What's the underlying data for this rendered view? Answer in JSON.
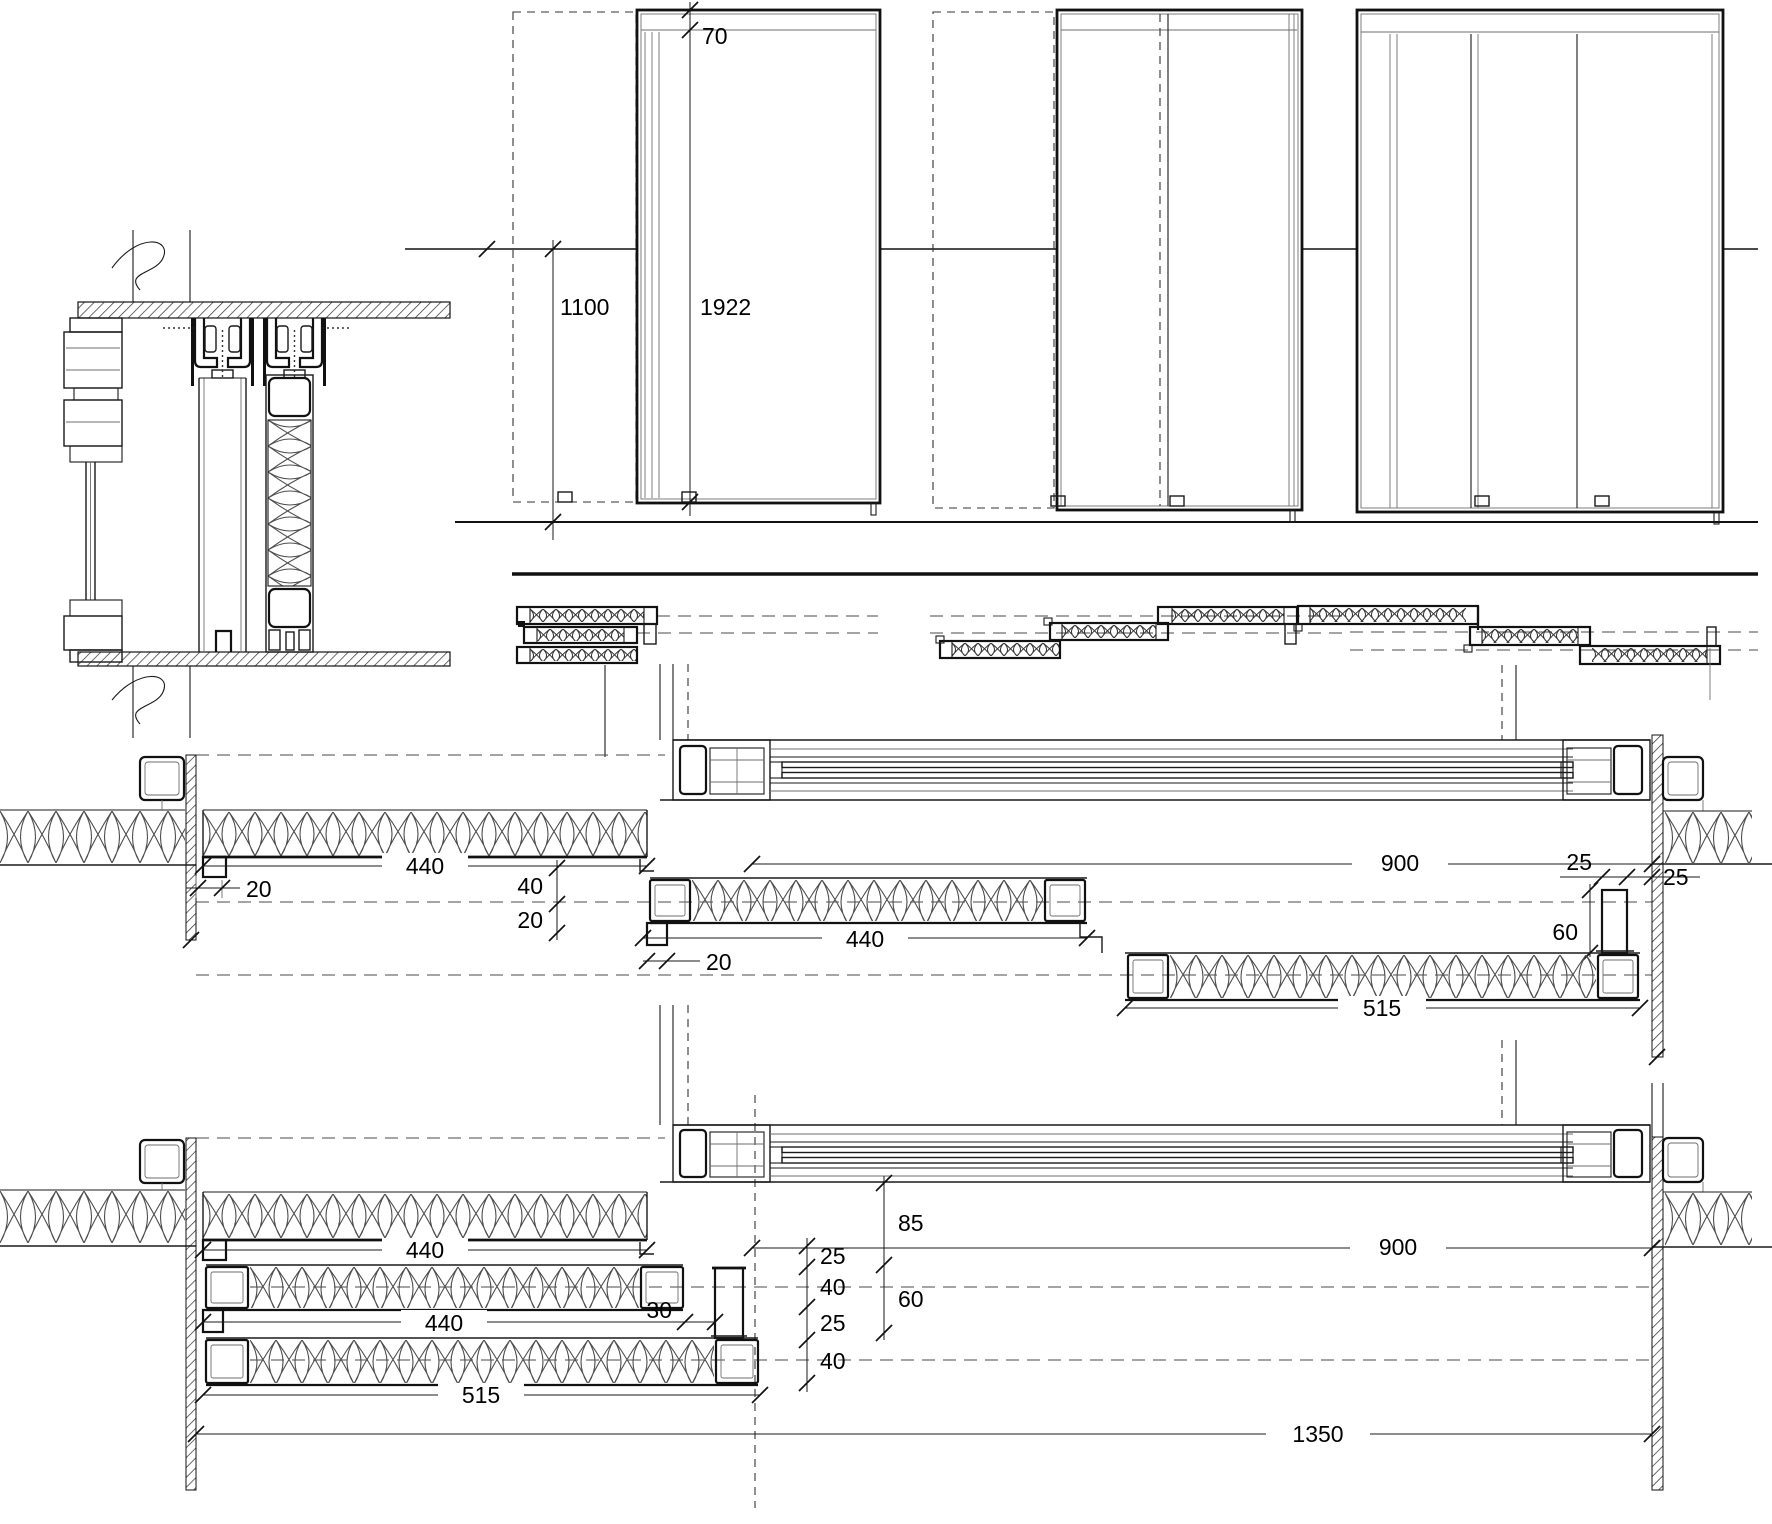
{
  "drawing": {
    "kind": "sliding-panel-door construction drawing",
    "colors": {
      "ink": "#1a1a1a",
      "muted": "#6e6e6e",
      "background": "#ffffff"
    }
  },
  "dims": {
    "elev": {
      "rail": "70",
      "pocket": "1100",
      "panel_h": "1922"
    },
    "mid": {
      "panel_a": "440",
      "off_a": "20",
      "v40": "40",
      "v20": "20",
      "panel_b": "440",
      "off_b": "20",
      "opening": "900",
      "stop_w": "25",
      "stop_gap": "25",
      "stop_h": "60",
      "panel_c": "515"
    },
    "bot": {
      "panel_a": "440",
      "panel_b": "440",
      "gap30": "30",
      "panel_c": "515",
      "v85": "85",
      "v25a": "25",
      "v40a": "40",
      "v25b": "25",
      "v40b": "40",
      "v60": "60",
      "opening": "900",
      "total": "1350"
    }
  }
}
